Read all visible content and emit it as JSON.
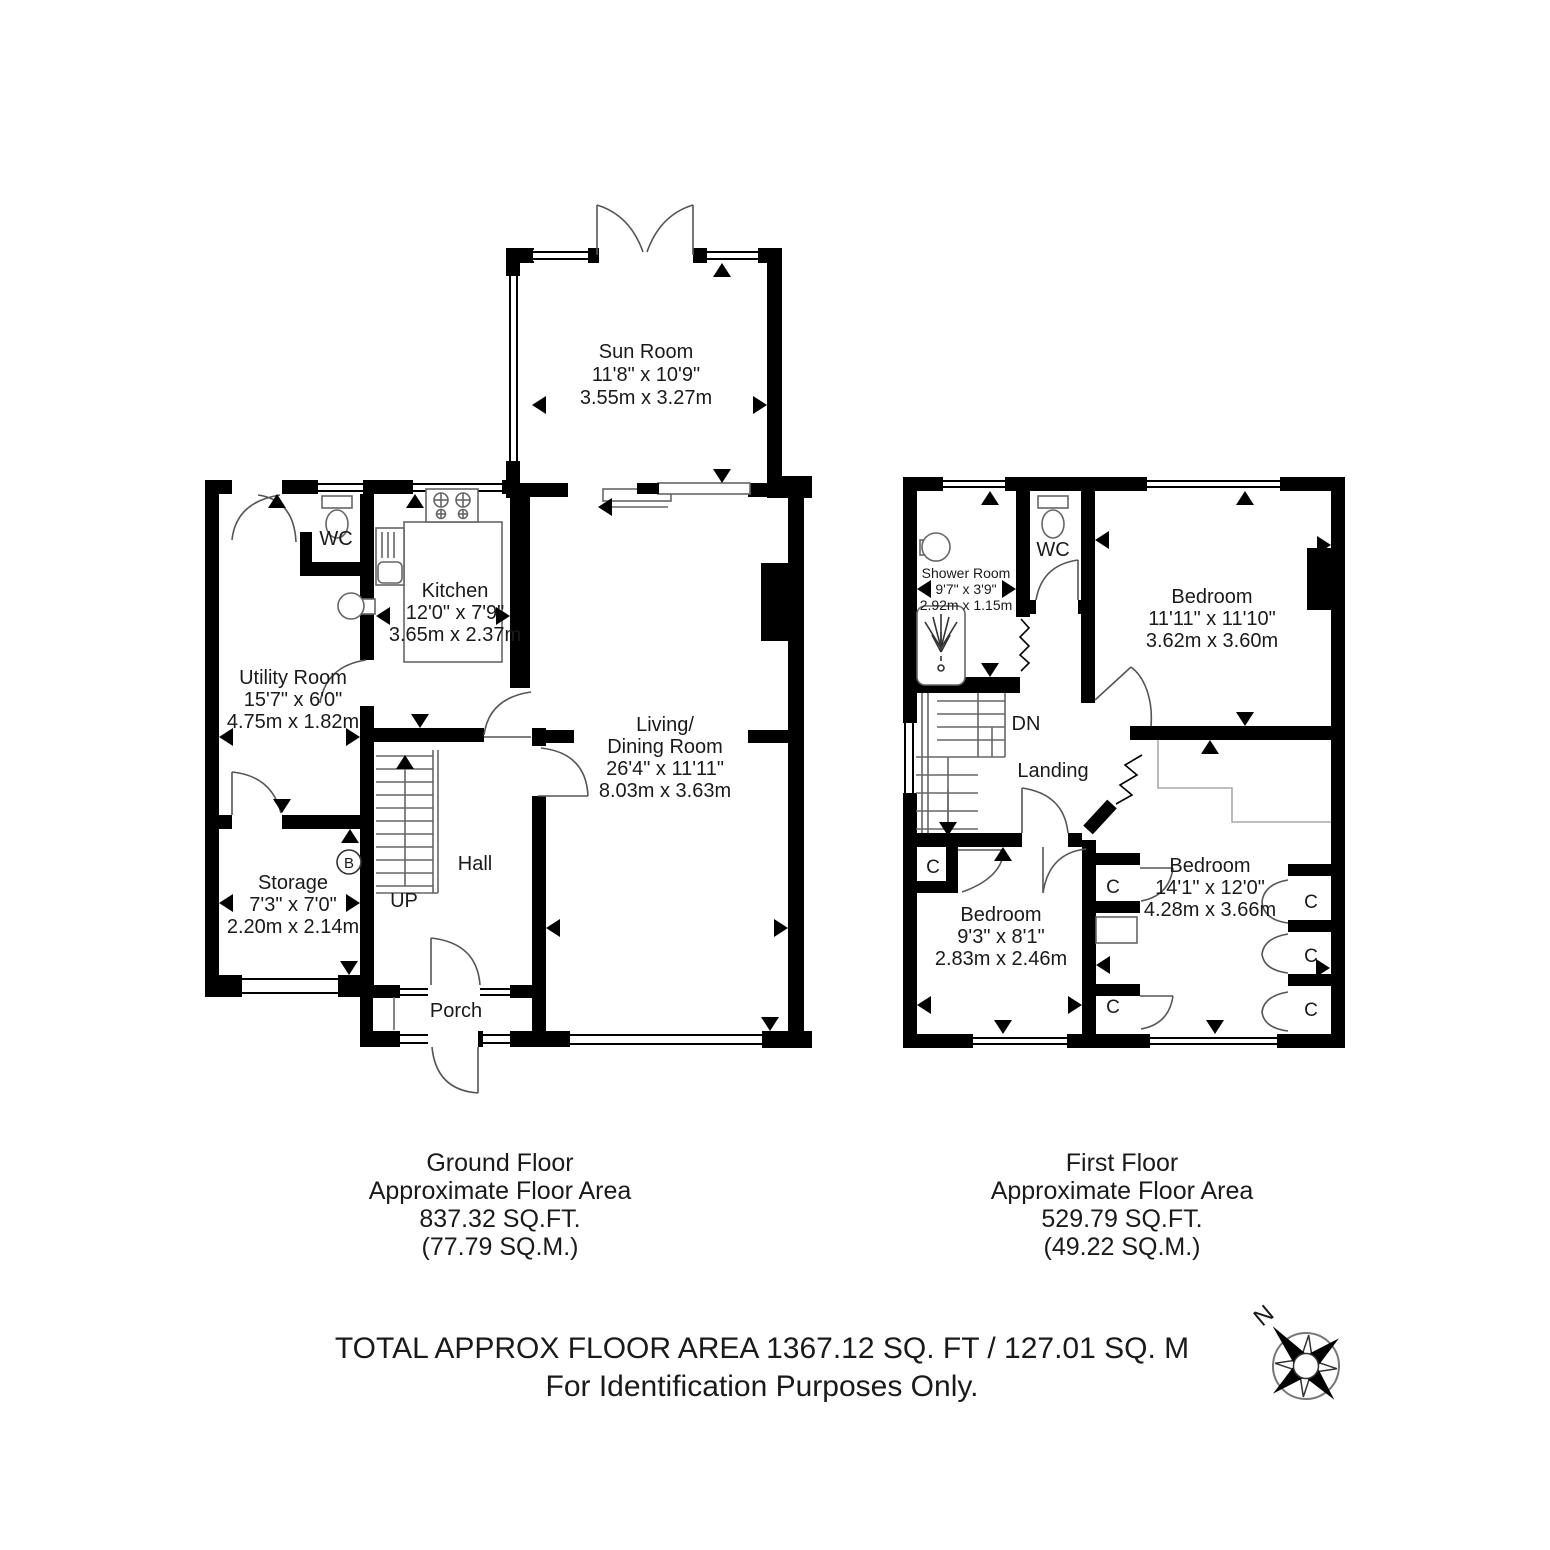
{
  "ground_floor": {
    "rooms": {
      "sun_room": {
        "name": "Sun Room",
        "imperial": "11'8\" x 10'9\"",
        "metric": "3.55m x 3.27m"
      },
      "kitchen": {
        "name": "Kitchen",
        "imperial": "12'0\" x 7'9\"",
        "metric": "3.65m x 2.37m"
      },
      "utility_room": {
        "name": "Utility Room",
        "imperial": "15'7\" x 6'0\"",
        "metric": "4.75m x 1.82m"
      },
      "storage": {
        "name": "Storage",
        "imperial": "7'3\" x 7'0\"",
        "metric": "2.20m x 2.14m"
      },
      "living_dining": {
        "name_line1": "Living/",
        "name_line2": "Dining Room",
        "imperial": "26'4\" x 11'11\"",
        "metric": "8.03m x 3.63m"
      },
      "wc": {
        "name": "WC"
      },
      "hall": {
        "name": "Hall"
      },
      "porch": {
        "name": "Porch"
      }
    },
    "stairs_label": "UP",
    "boiler_label": "B",
    "caption": {
      "line1": "Ground Floor",
      "line2": "Approximate Floor Area",
      "line3": "837.32 SQ.FT.",
      "line4": "(77.79 SQ.M.)"
    }
  },
  "first_floor": {
    "rooms": {
      "shower_room": {
        "name": "Shower Room",
        "imperial": "9'7\" x 3'9\"",
        "metric": "2.92m x 1.15m"
      },
      "wc": {
        "name": "WC"
      },
      "landing": {
        "name": "Landing"
      },
      "bedroom_rear": {
        "name": "Bedroom",
        "imperial": "11'11\" x 11'10\"",
        "metric": "3.62m x 3.60m"
      },
      "bedroom_front": {
        "name": "Bedroom",
        "imperial": "14'1\" x 12'0\"",
        "metric": "4.28m x 3.66m"
      },
      "bedroom_small": {
        "name": "Bedroom",
        "imperial": "9'3\" x 8'1\"",
        "metric": "2.83m x 2.46m"
      },
      "closet_label": "C"
    },
    "stairs_label": "DN",
    "caption": {
      "line1": "First Floor",
      "line2": "Approximate Floor Area",
      "line3": "529.79 SQ.FT.",
      "line4": "(49.22 SQ.M.)"
    }
  },
  "footer": {
    "line1": "TOTAL APPROX FLOOR AREA 1367.12 SQ. FT / 127.01 SQ. M",
    "line2": "For Identification Purposes Only."
  },
  "compass": {
    "north_label": "N"
  }
}
